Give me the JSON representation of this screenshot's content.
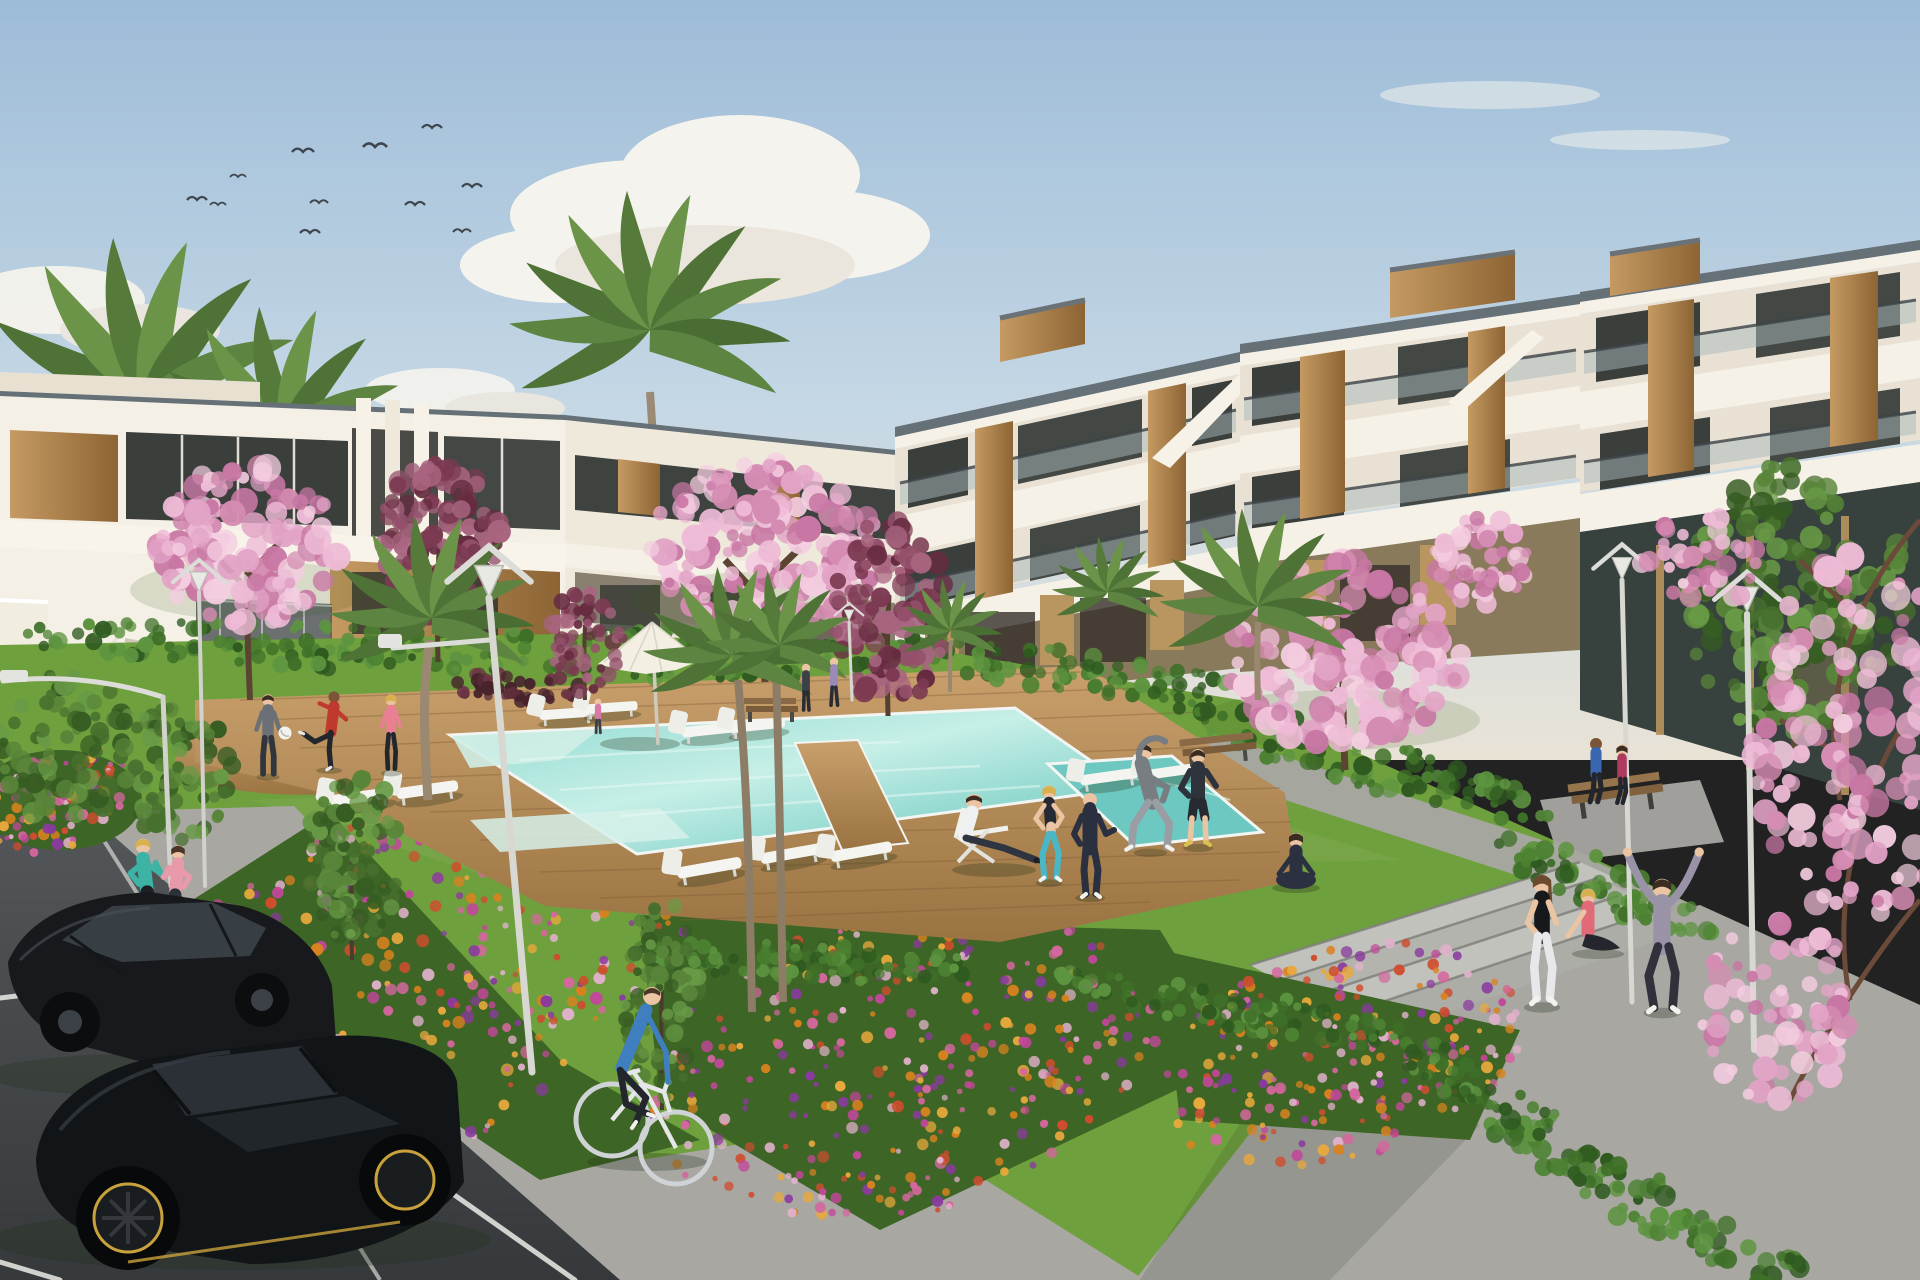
{
  "scene": {
    "kind": "architectural-exterior-render",
    "time_of_day": "late afternoon",
    "subjects": [
      "two-storey white townhouse block",
      "three-storey white apartment block with wood accents",
      "communal swimming pool",
      "lawn with exercising residents",
      "flower beds",
      "parking with two black cars",
      "palm and cherry-blossom trees"
    ]
  },
  "colors": {
    "sky_top": "#9dbcd8",
    "sky_mid": "#c6d8e5",
    "sky_horizon": "#e9e3d6",
    "cloud": "#f8f5ee",
    "building_white": "#f5f0e6",
    "building_shade": "#e9e2d4",
    "building_dim": "#ddd5c5",
    "roof_cap": "#667077",
    "wood_light": "#c59a62",
    "wood_dark": "#8d6434",
    "glass_dark": "#3a3f3c",
    "balustrade": "#a9b7ba",
    "lawn": "#6fa03e",
    "lawn_dark": "#55842c",
    "pool_light": "#c6efe7",
    "pool_mid": "#8ed9d0",
    "pool_deep": "#5fc3ba",
    "deck_light": "#c9a06c",
    "deck_dark": "#9a7342",
    "path": "#a8a7a2",
    "steps": "#b9b9b4",
    "road": "#46494b",
    "lamp": "#e3e3df",
    "car_black": "#121517",
    "skin": "#eac4a3",
    "skin_dark": "#7c5538",
    "ball_white": "#f2f2ee"
  },
  "palettes": {
    "flowers": [
      "#d9821f",
      "#e8a93c",
      "#c2479a",
      "#d4679e",
      "#8a3a9e",
      "#cf4d2e",
      "#e0b1cb"
    ],
    "hedge": [
      "#2f5a20",
      "#3e7028",
      "#4c8232",
      "#5d9440"
    ],
    "tree_green": [
      "#47702e",
      "#588539",
      "#689a46",
      "#365c22"
    ],
    "blossom": [
      "#eebbd6",
      "#e2a3c6",
      "#d58cb2",
      "#f4cde0",
      "#c877a4"
    ],
    "autumn": [
      "#7c3a52",
      "#94506b",
      "#662b40",
      "#a8647f"
    ],
    "dark_bush": [
      "#5e2d3a",
      "#6e3545",
      "#46222c"
    ]
  },
  "birds": [
    [
      187,
      200,
      1
    ],
    [
      210,
      205,
      0.8
    ],
    [
      230,
      177,
      0.8
    ],
    [
      292,
      152,
      1.1
    ],
    [
      300,
      233,
      1
    ],
    [
      310,
      203,
      0.9
    ],
    [
      363,
      147,
      1.2
    ],
    [
      405,
      205,
      1
    ],
    [
      422,
      128,
      1
    ],
    [
      453,
      232,
      0.9
    ],
    [
      462,
      187,
      1
    ]
  ],
  "scatter": [
    {
      "target": "#g-bedA",
      "cx": 400,
      "cy": 985,
      "rx": 320,
      "ry": 170,
      "rot": -28,
      "n": 420,
      "rmin": 2.5,
      "rmax": 6.5,
      "palette": "flowers",
      "seed": 11
    },
    {
      "target": "#g-bedB",
      "cx": 900,
      "cy": 1065,
      "rx": 260,
      "ry": 150,
      "rot": -12,
      "n": 340,
      "rmin": 2.5,
      "rmax": 6,
      "palette": "flowers",
      "seed": 12
    },
    {
      "target": "#g-bedC",
      "cx": 1340,
      "cy": 1055,
      "rx": 190,
      "ry": 105,
      "rot": -15,
      "n": 240,
      "rmin": 2.5,
      "rmax": 6,
      "palette": "flowers",
      "seed": 13
    },
    {
      "target": "#g-bedD",
      "cx": 60,
      "cy": 800,
      "rx": 80,
      "ry": 48,
      "rot": -20,
      "n": 90,
      "rmin": 2.5,
      "rmax": 6,
      "palette": "flowers",
      "seed": 14
    },
    {
      "target": "#g-hedge-left",
      "cx": 450,
      "cy": 650,
      "rx": 460,
      "ry": 24,
      "rot": 2,
      "n": 170,
      "rmin": 4,
      "rmax": 9,
      "palette": "hedge",
      "seed": 21
    },
    {
      "target": "#g-hedge-r1",
      "cx": 1060,
      "cy": 668,
      "rx": 185,
      "ry": 22,
      "rot": 8,
      "n": 85,
      "rmin": 4,
      "rmax": 9,
      "palette": "hedge",
      "seed": 22
    },
    {
      "target": "#g-hedge-r2",
      "cx": 1365,
      "cy": 762,
      "rx": 195,
      "ry": 26,
      "rot": 16,
      "n": 95,
      "rmin": 4,
      "rmax": 10,
      "palette": "hedge",
      "seed": 23
    },
    {
      "target": "#g-hedge-r3",
      "cx": 1600,
      "cy": 882,
      "rx": 125,
      "ry": 24,
      "rot": 22,
      "n": 60,
      "rmin": 4,
      "rmax": 10,
      "palette": "hedge",
      "seed": 24
    },
    {
      "target": "#g-hedge-b1",
      "cx": 800,
      "cy": 962,
      "rx": 190,
      "ry": 18,
      "rot": 2,
      "n": 85,
      "rmin": 4,
      "rmax": 8,
      "palette": "hedge",
      "seed": 25
    },
    {
      "target": "#g-hedge-b2",
      "cx": 1250,
      "cy": 1012,
      "rx": 200,
      "ry": 20,
      "rot": 10,
      "n": 90,
      "rmin": 4,
      "rmax": 8,
      "palette": "hedge",
      "seed": 26
    },
    {
      "target": "#g-hedge-b3",
      "cx": 1480,
      "cy": 1090,
      "rx": 95,
      "ry": 18,
      "rot": 25,
      "n": 45,
      "rmin": 4,
      "rmax": 8,
      "palette": "hedge",
      "seed": 27
    },
    {
      "target": "#g-hedge-path",
      "cx": 1655,
      "cy": 1205,
      "rx": 195,
      "ry": 28,
      "rot": 28,
      "n": 95,
      "rmin": 5,
      "rmax": 11,
      "palette": "hedge",
      "seed": 28
    },
    {
      "target": "#g-hedge-pool",
      "cx": 700,
      "cy": 642,
      "rx": 150,
      "ry": 14,
      "rot": 0,
      "n": 60,
      "rmin": 4,
      "rmax": 8,
      "palette": "hedge",
      "seed": 29
    },
    {
      "target": "#g-shrubL1",
      "cx": 65,
      "cy": 745,
      "rx": 75,
      "ry": 75,
      "rot": 0,
      "n": 80,
      "rmin": 5,
      "rmax": 11,
      "palette": "tree_green",
      "seed": 30
    },
    {
      "target": "#g-shrubL2",
      "cx": 178,
      "cy": 772,
      "rx": 60,
      "ry": 68,
      "rot": 0,
      "n": 70,
      "rmin": 5,
      "rmax": 10,
      "palette": "tree_green",
      "seed": 31
    },
    {
      "target": "#g-bush-red",
      "cx": 518,
      "cy": 688,
      "rx": 78,
      "ry": 15,
      "rot": 3,
      "n": 42,
      "rmin": 4,
      "rmax": 8,
      "palette": "dark_bush",
      "seed": 32
    },
    {
      "target": "#g-P1",
      "cx": 248,
      "cy": 545,
      "rx": 95,
      "ry": 80,
      "rot": 0,
      "n": 135,
      "rmin": 5,
      "rmax": 14,
      "palette": "blossom",
      "seed": 41
    },
    {
      "target": "#g-A1",
      "cx": 440,
      "cy": 540,
      "rx": 60,
      "ry": 86,
      "rot": 0,
      "n": 110,
      "rmin": 5,
      "rmax": 12,
      "palette": "autumn",
      "seed": 42
    },
    {
      "target": "#g-P2",
      "cx": 765,
      "cy": 545,
      "rx": 115,
      "ry": 82,
      "rot": 0,
      "n": 150,
      "rmin": 5,
      "rmax": 14,
      "palette": "blossom",
      "seed": 43
    },
    {
      "target": "#g-A2",
      "cx": 890,
      "cy": 612,
      "rx": 56,
      "ry": 95,
      "rot": 0,
      "n": 110,
      "rmin": 5,
      "rmax": 12,
      "palette": "autumn",
      "seed": 44
    },
    {
      "target": "#g-P3",
      "cx": 1345,
      "cy": 655,
      "rx": 120,
      "ry": 95,
      "rot": 0,
      "n": 150,
      "rmin": 6,
      "rmax": 15,
      "palette": "blossom",
      "seed": 45
    },
    {
      "target": "#g-P4",
      "cx": 1482,
      "cy": 560,
      "rx": 48,
      "ry": 44,
      "rot": 0,
      "n": 50,
      "rmin": 5,
      "rmax": 11,
      "palette": "blossom",
      "seed": 46
    },
    {
      "target": "#g-G1",
      "cx": 1795,
      "cy": 600,
      "rx": 112,
      "ry": 138,
      "rot": 0,
      "n": 175,
      "rmin": 6,
      "rmax": 13,
      "palette": "tree_green",
      "seed": 47
    },
    {
      "target": "#g-G2",
      "cx": 352,
      "cy": 855,
      "rx": 50,
      "ry": 88,
      "rot": 0,
      "n": 90,
      "rmin": 4,
      "rmax": 10,
      "palette": "tree_green",
      "seed": 48
    },
    {
      "target": "#g-G3",
      "cx": 662,
      "cy": 1000,
      "rx": 38,
      "ry": 100,
      "rot": 0,
      "n": 80,
      "rmin": 4,
      "rmax": 9,
      "palette": "tree_green",
      "seed": 49
    },
    {
      "target": "#g-A3",
      "cx": 585,
      "cy": 640,
      "rx": 38,
      "ry": 52,
      "rot": 0,
      "n": 55,
      "rmin": 4,
      "rmax": 9,
      "palette": "autumn",
      "seed": 50
    },
    {
      "target": "#g-P5a",
      "cx": 1858,
      "cy": 735,
      "rx": 105,
      "ry": 185,
      "rot": 0,
      "n": 130,
      "rmin": 6,
      "rmax": 16,
      "palette": "blossom",
      "seed": 51
    },
    {
      "target": "#g-P5b",
      "cx": 1778,
      "cy": 1010,
      "rx": 80,
      "ry": 92,
      "rot": 0,
      "n": 70,
      "rmin": 5,
      "rmax": 13,
      "palette": "blossom",
      "seed": 52
    },
    {
      "target": "#g-P5c",
      "cx": 1700,
      "cy": 562,
      "rx": 60,
      "ry": 46,
      "rot": 0,
      "n": 40,
      "rmin": 5,
      "rmax": 11,
      "palette": "blossom",
      "seed": 53
    }
  ],
  "people": [
    {
      "name": "jogger-woman-teal",
      "activity": "jogging",
      "top": "#3cb3a5",
      "bottom": "#1c1f24"
    },
    {
      "name": "jogger-woman-pink",
      "activity": "jogging",
      "top": "#e89aab",
      "bottom": "#2c3038"
    },
    {
      "name": "cyclist-man-blue",
      "activity": "cycling",
      "top": "#3f7fc0",
      "bottom": "#23262c"
    },
    {
      "name": "footballer-man-gray",
      "activity": "playing football",
      "top": "#6a7076",
      "bottom": "#31363c"
    },
    {
      "name": "footballer-man-red",
      "activity": "kicking ball",
      "top": "#c0392e",
      "bottom": "#23262c"
    },
    {
      "name": "footballer-woman-pink",
      "activity": "playing",
      "top": "#e87f93",
      "bottom": "#23262c"
    },
    {
      "name": "man-deckchair",
      "activity": "lounging",
      "top": "#eef0f2",
      "bottom": "#2e3440"
    },
    {
      "name": "woman-sport-top",
      "activity": "exercising",
      "top": "#262a33",
      "bottom": "#49b7c6"
    },
    {
      "name": "person-hoodie",
      "activity": "exercising",
      "top": "#2b3040",
      "bottom": "#2b3040"
    },
    {
      "name": "man-stretching-gray",
      "activity": "side stretch",
      "top": "#787d82",
      "bottom": "#9a9da3"
    },
    {
      "name": "man-dark-shorts",
      "activity": "exercising",
      "top": "#2e333b",
      "bottom": "#262b31"
    },
    {
      "name": "woman-yoga-seated",
      "activity": "yoga",
      "top": "#2c3142",
      "bottom": "#2c3142"
    },
    {
      "name": "bench-couple-man",
      "activity": "sitting on bench",
      "top": "#3a66b0",
      "bottom": "#23262c"
    },
    {
      "name": "bench-couple-woman",
      "activity": "sitting on bench",
      "top": "#b03a5e",
      "bottom": "#23262c"
    },
    {
      "name": "woman-black-top",
      "activity": "standing",
      "top": "#17181c",
      "bottom": "#e8e8ea"
    },
    {
      "name": "woman-pink-sitting",
      "activity": "sitting on steps",
      "top": "#e06a78",
      "bottom": "#23262c"
    },
    {
      "name": "woman-stretch-hoodie",
      "activity": "arms-up stretch",
      "top": "#9a93a8",
      "bottom": "#32303a"
    }
  ],
  "furniture": {
    "sun_loungers": 11,
    "parasols": 1,
    "benches": 3,
    "street_lamps": 6
  },
  "vehicles": [
    {
      "type": "sedan",
      "color": "black"
    },
    {
      "type": "hatchback",
      "color": "black"
    },
    {
      "type": "bicycle",
      "color": "white"
    }
  ]
}
